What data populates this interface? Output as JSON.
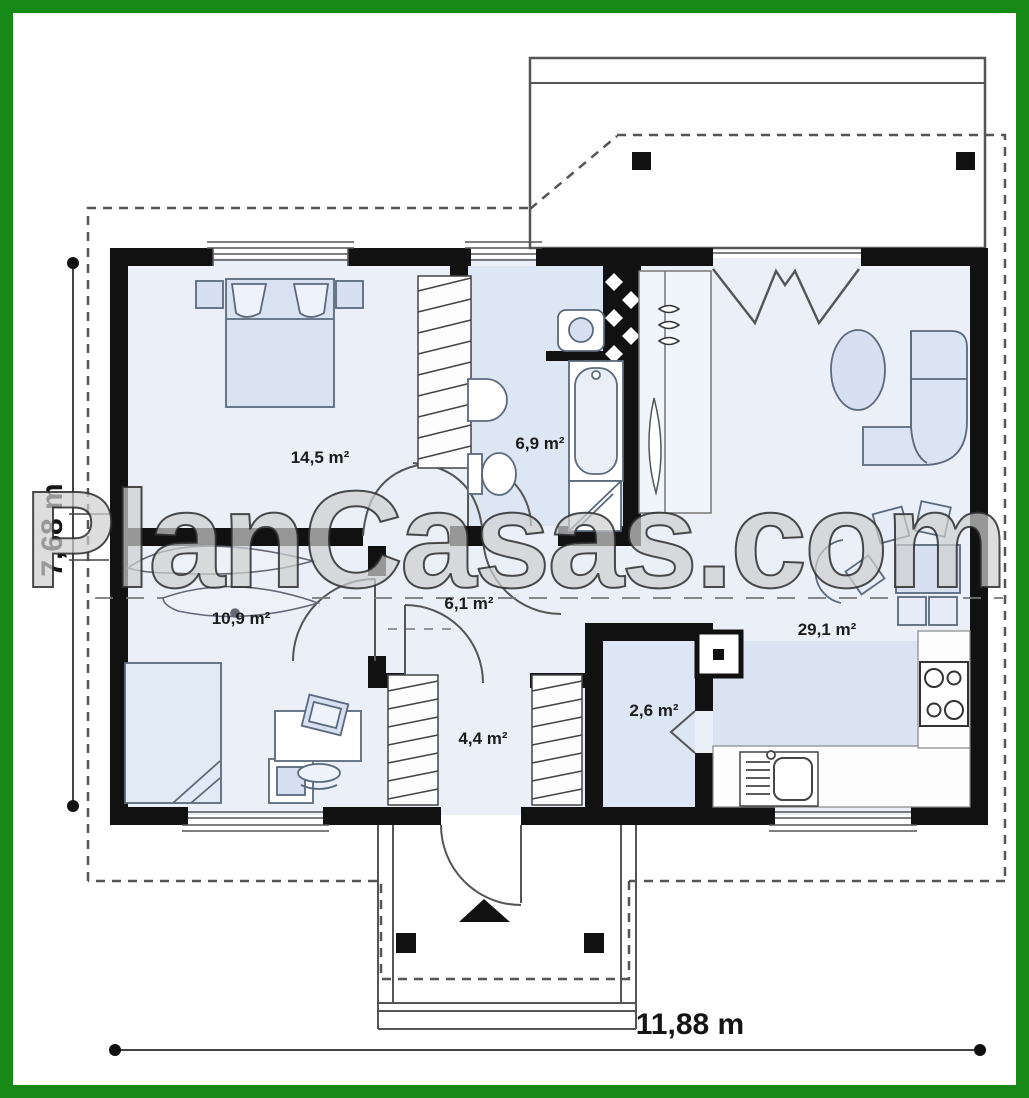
{
  "plan": {
    "watermark": "PlanCasas.com",
    "rooms": [
      {
        "id": "bedroom",
        "area_label": "14,5 m²"
      },
      {
        "id": "bathroom",
        "area_label": "6,9 m²"
      },
      {
        "id": "bedroom-2",
        "area_label": "10,9 m²"
      },
      {
        "id": "hall",
        "area_label": "6,1 m²"
      },
      {
        "id": "entry",
        "area_label": "4,4 m²"
      },
      {
        "id": "pantry",
        "area_label": "2,6 m²"
      },
      {
        "id": "living-kitchen",
        "area_label": "29,1 m²"
      }
    ],
    "dimensions": {
      "overall_depth_label": "7,68 m",
      "overall_width_label": "11,88 m"
    },
    "icons": {
      "entrance_arrow": "entrance-arrow-icon"
    },
    "colors": {
      "frame_green": "#178917",
      "wall_black": "#111111",
      "floor_light_blue": "#eaeff8",
      "floor_blue": "#dde7f4",
      "floor_medium_blue": "#d9e3f2",
      "furniture_blue": "#d6e0f0"
    }
  }
}
